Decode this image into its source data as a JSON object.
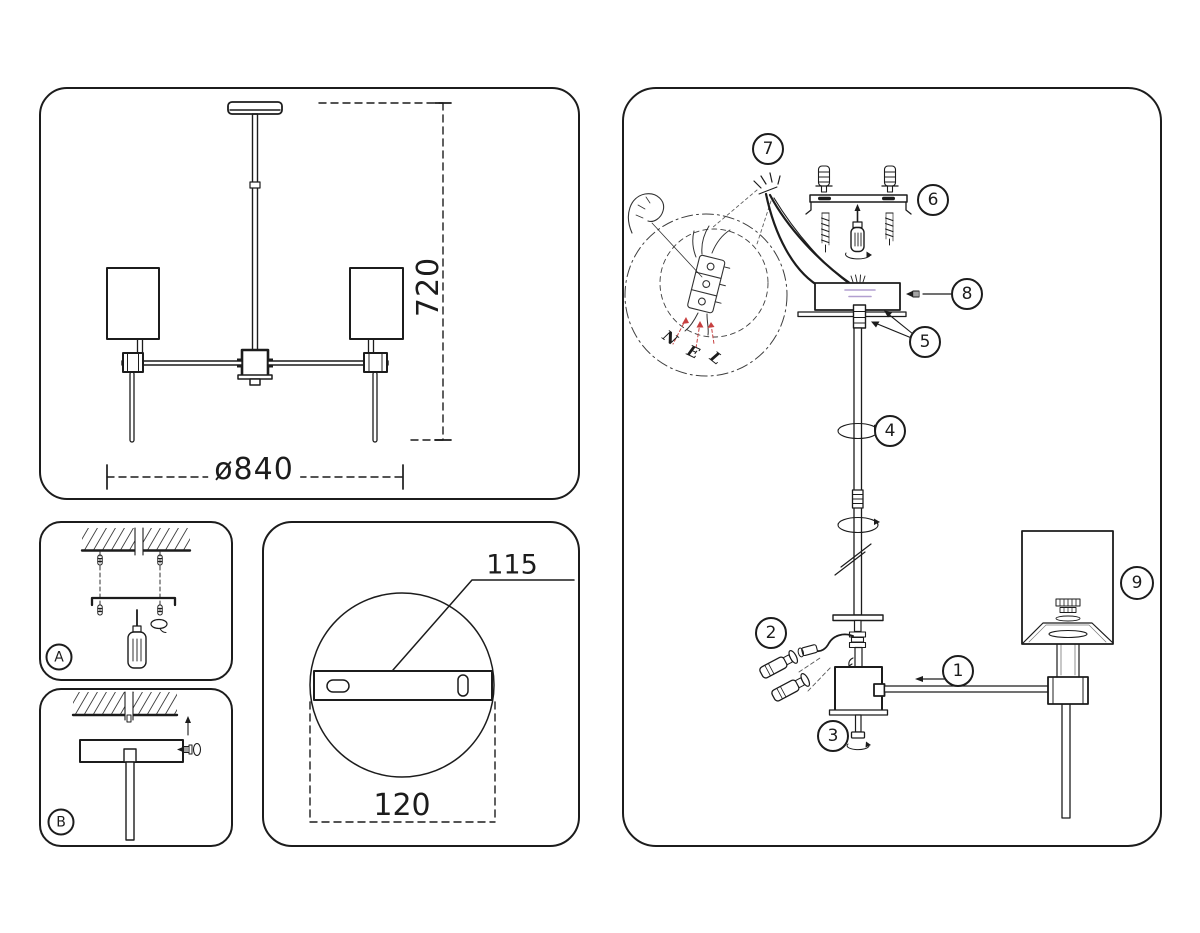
{
  "colors": {
    "line": "#1c1c1c",
    "red_accent": "#c74040",
    "purple_accent": "#b29fd0"
  },
  "overview_panel": {
    "height_dim": "720",
    "diameter_dim": "ø840"
  },
  "step_panels": {
    "a_label": "A",
    "b_label": "B"
  },
  "plate_detail_panel": {
    "hole_spacing_dim": "115",
    "plate_width_dim": "120"
  },
  "assembly_panel": {
    "callouts": [
      "1",
      "2",
      "3",
      "4",
      "5",
      "6",
      "7",
      "8",
      "9"
    ],
    "wire_labels": [
      "N",
      "E",
      "L"
    ]
  }
}
